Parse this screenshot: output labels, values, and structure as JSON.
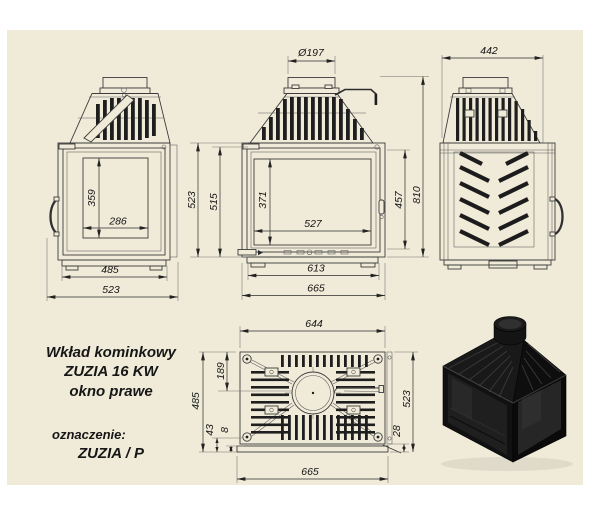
{
  "page": {
    "paper_color": "#f0ebd9",
    "line_color": "#3c3c3c"
  },
  "title_block": {
    "line1": "Wkład kominkowy",
    "line2": "ZUZIA 16 KW",
    "line3": "okno prawe",
    "designation_label": "oznaczenie:",
    "designation_value": "ZUZIA / P"
  },
  "side_view": {
    "window_height": "359",
    "window_width": "286",
    "body_width": "485",
    "overall_width": "523"
  },
  "front_view": {
    "flue_diameter": "Ø197",
    "overall_height_left": "523",
    "inner_height_left": "515",
    "window_height": "371",
    "window_width": "527",
    "door_height": "457",
    "overall_height": "810",
    "inner_width": "613",
    "overall_width": "665"
  },
  "rear_view": {
    "overall_width": "442"
  },
  "top_view": {
    "inner_width": "644",
    "flue_offset": "189",
    "inner_depth": "485",
    "front_gap": "43",
    "plate_gap": "8",
    "rear_gap": "28",
    "overall_depth": "523",
    "overall_width": "665"
  }
}
